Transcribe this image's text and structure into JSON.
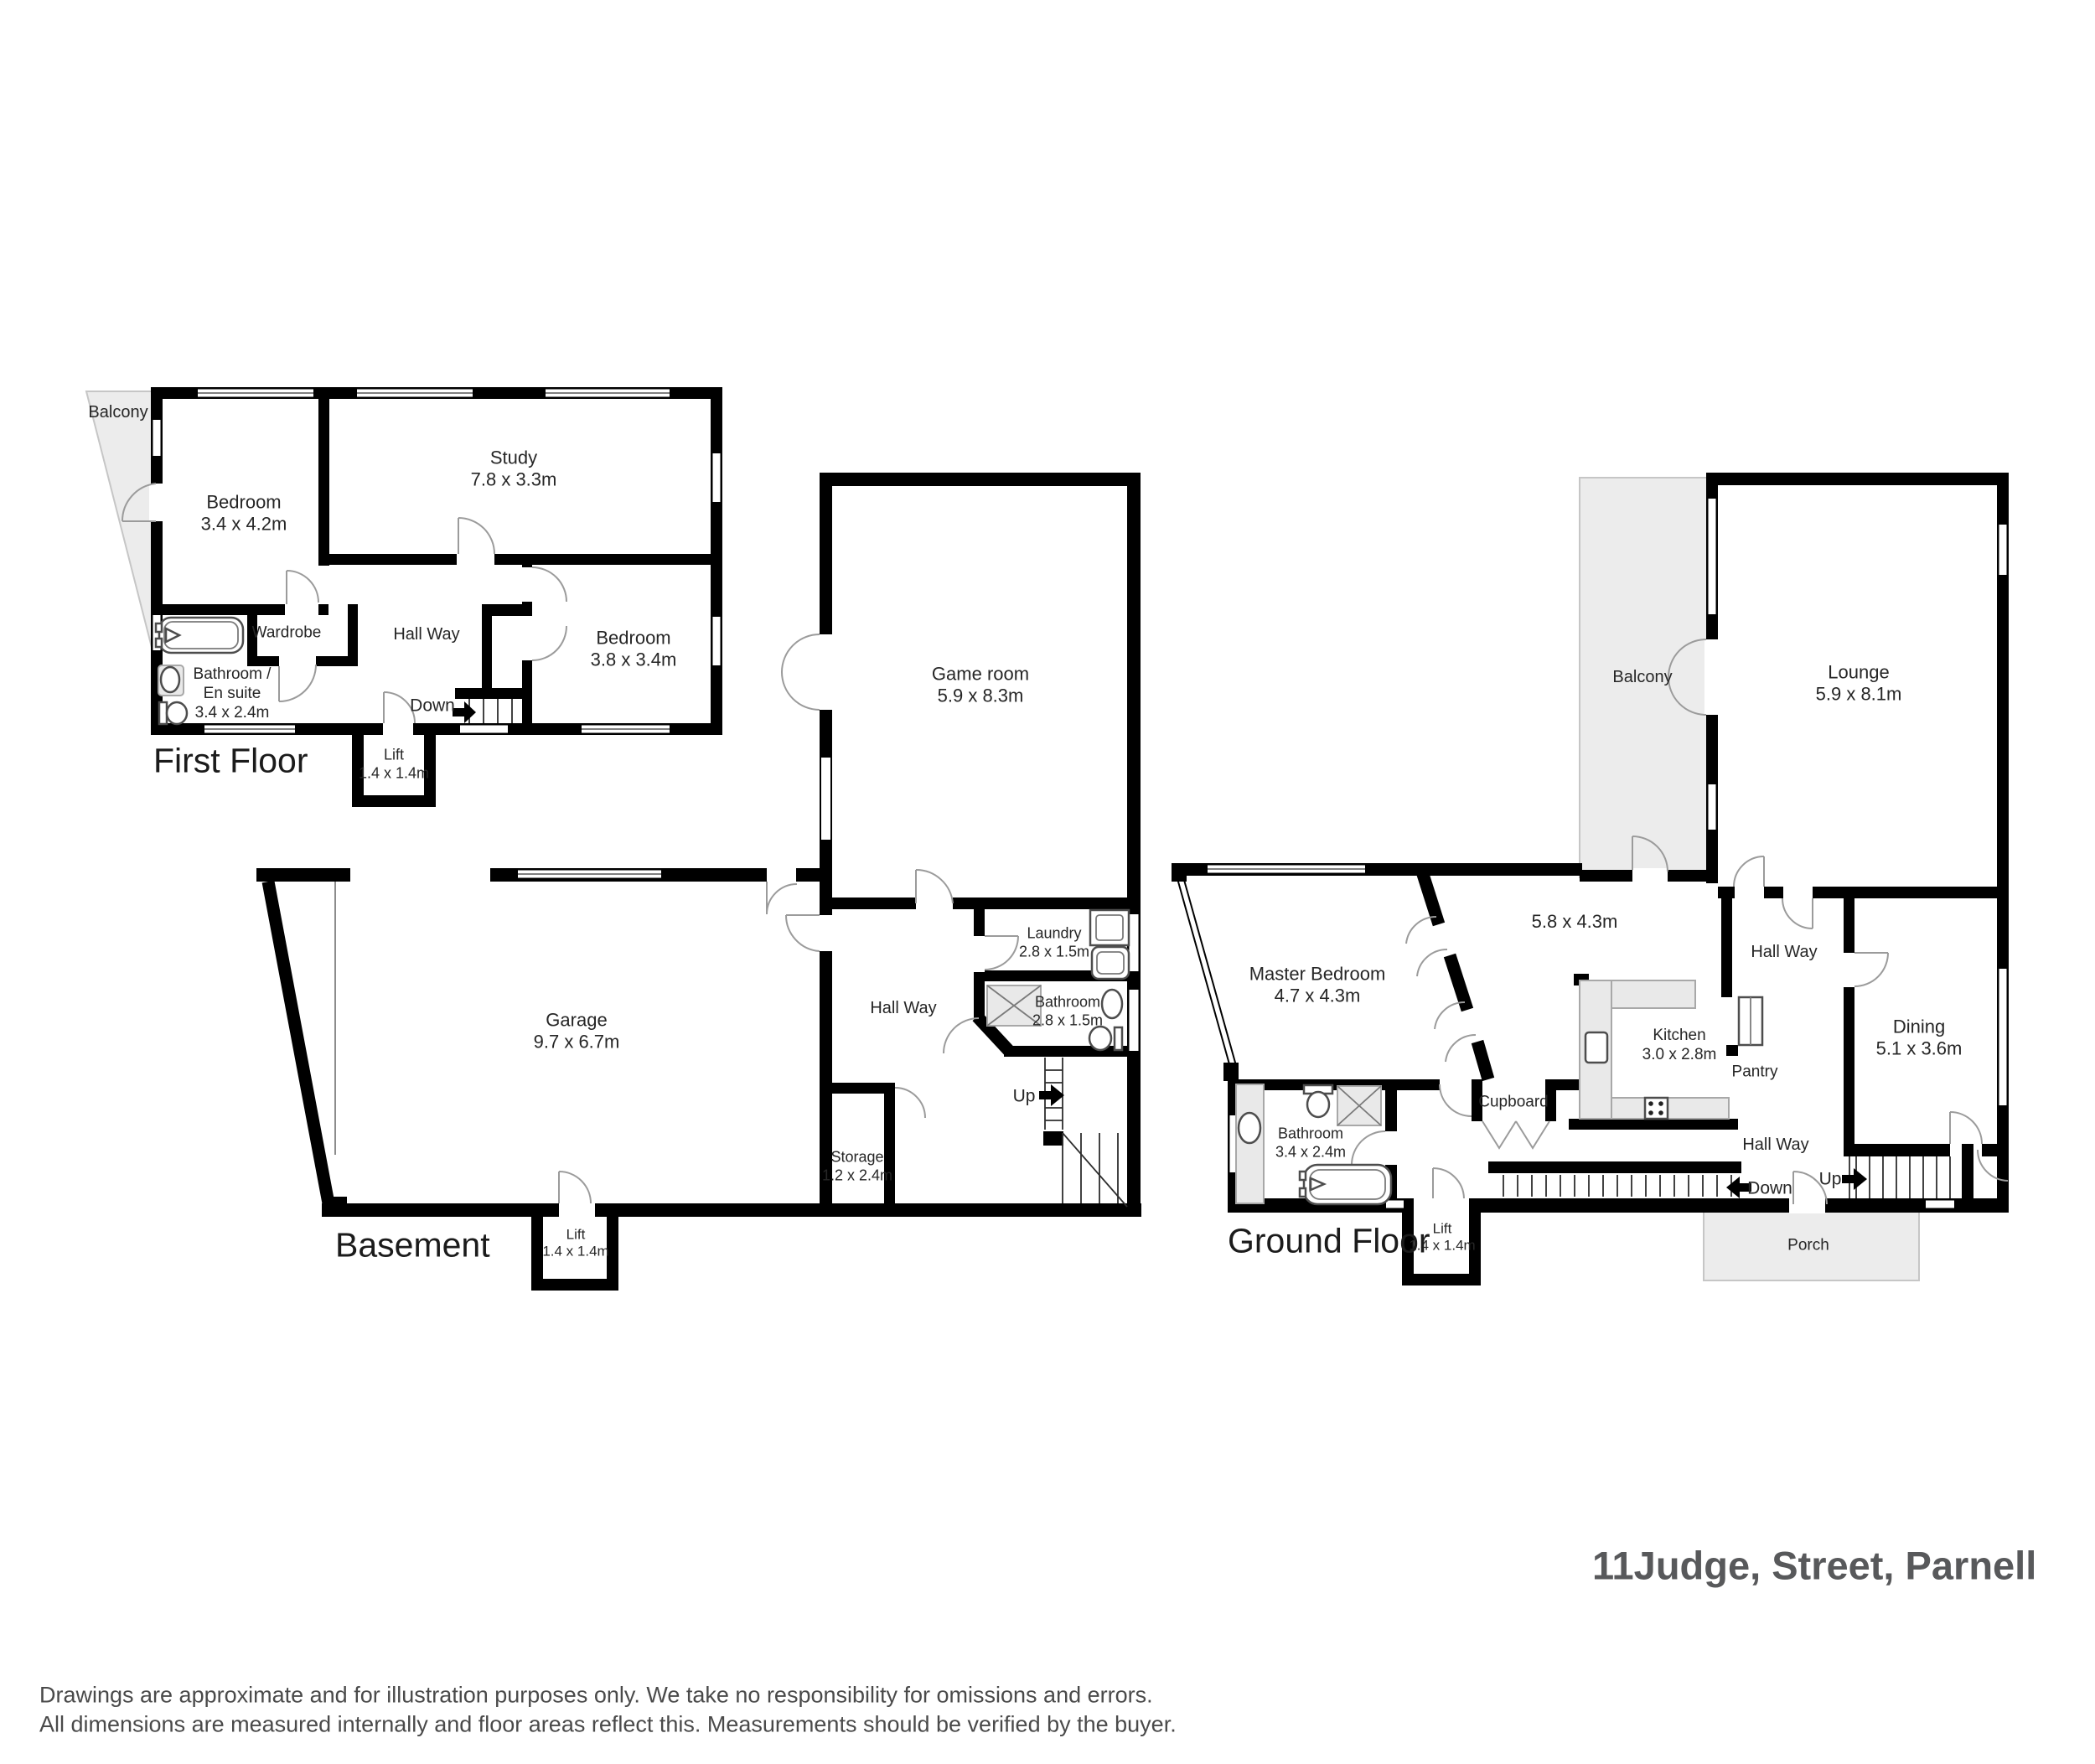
{
  "address": "11Judge, Street, Parnell",
  "disclaimer": {
    "line1": "Drawings are approximate and for illustration purposes only. We take no responsibility for omissions and errors.",
    "line2": "All dimensions are measured internally and floor areas reflect this. Measurements should be verified by the buyer."
  },
  "colors": {
    "wall": "#000000",
    "area_fill": "#ececec",
    "label_text": "#262626",
    "address_text": "#58595b"
  },
  "floors": {
    "first_floor": {
      "title": "First Floor",
      "rooms": {
        "balcony": "Balcony",
        "bedroom1": {
          "name": "Bedroom",
          "dims": "3.4 x 4.2m"
        },
        "study": {
          "name": "Study",
          "dims": "7.8 x 3.3m"
        },
        "wardrobe": "Wardrobe",
        "hallway": "Hall Way",
        "bathroom": {
          "line1": "Bathroom /",
          "line2": "En suite",
          "dims": "3.4 x 2.4m"
        },
        "bedroom2": {
          "name": "Bedroom",
          "dims": "3.8 x 3.4m"
        },
        "lift": {
          "name": "Lift",
          "dims": "1.4 x 1.4m"
        },
        "down": "Down"
      }
    },
    "basement": {
      "title": "Basement",
      "rooms": {
        "game_room": {
          "name": "Game room",
          "dims": "5.9 x 8.3m"
        },
        "garage": {
          "name": "Garage",
          "dims": "9.7 x 6.7m"
        },
        "hallway": "Hall Way",
        "laundry": {
          "name": "Laundry",
          "dims": "2.8 x 1.5m"
        },
        "bathroom": {
          "name": "Bathroom",
          "dims": "2.8 x 1.5m"
        },
        "storage": {
          "name": "Storage",
          "dims": "1.2 x 2.4m"
        },
        "lift": {
          "name": "Lift",
          "dims": "1.4 x 1.4m"
        },
        "up": "Up"
      }
    },
    "ground_floor": {
      "title": "Ground Floor",
      "rooms": {
        "balcony": "Balcony",
        "lounge": {
          "name": "Lounge",
          "dims": "5.9 x 8.1m"
        },
        "master_bedroom": {
          "name": "Master Bedroom",
          "dims": "4.7 x 4.3m"
        },
        "family_room_dims": "5.8 x 4.3m",
        "hallway_upper": "Hall Way",
        "kitchen": {
          "name": "Kitchen",
          "dims": "3.0 x 2.8m"
        },
        "pantry": "Pantry",
        "dining": {
          "name": "Dining",
          "dims": "5.1 x 3.6m"
        },
        "cupboard": "Cupboard",
        "hallway_lower": "Hall Way",
        "bathroom": {
          "name": "Bathroom",
          "dims": "3.4 x 2.4m"
        },
        "lift": {
          "name": "Lift",
          "dims": "1.4 x 1.4m"
        },
        "porch": "Porch",
        "down": "Down",
        "up": "Up"
      }
    }
  }
}
